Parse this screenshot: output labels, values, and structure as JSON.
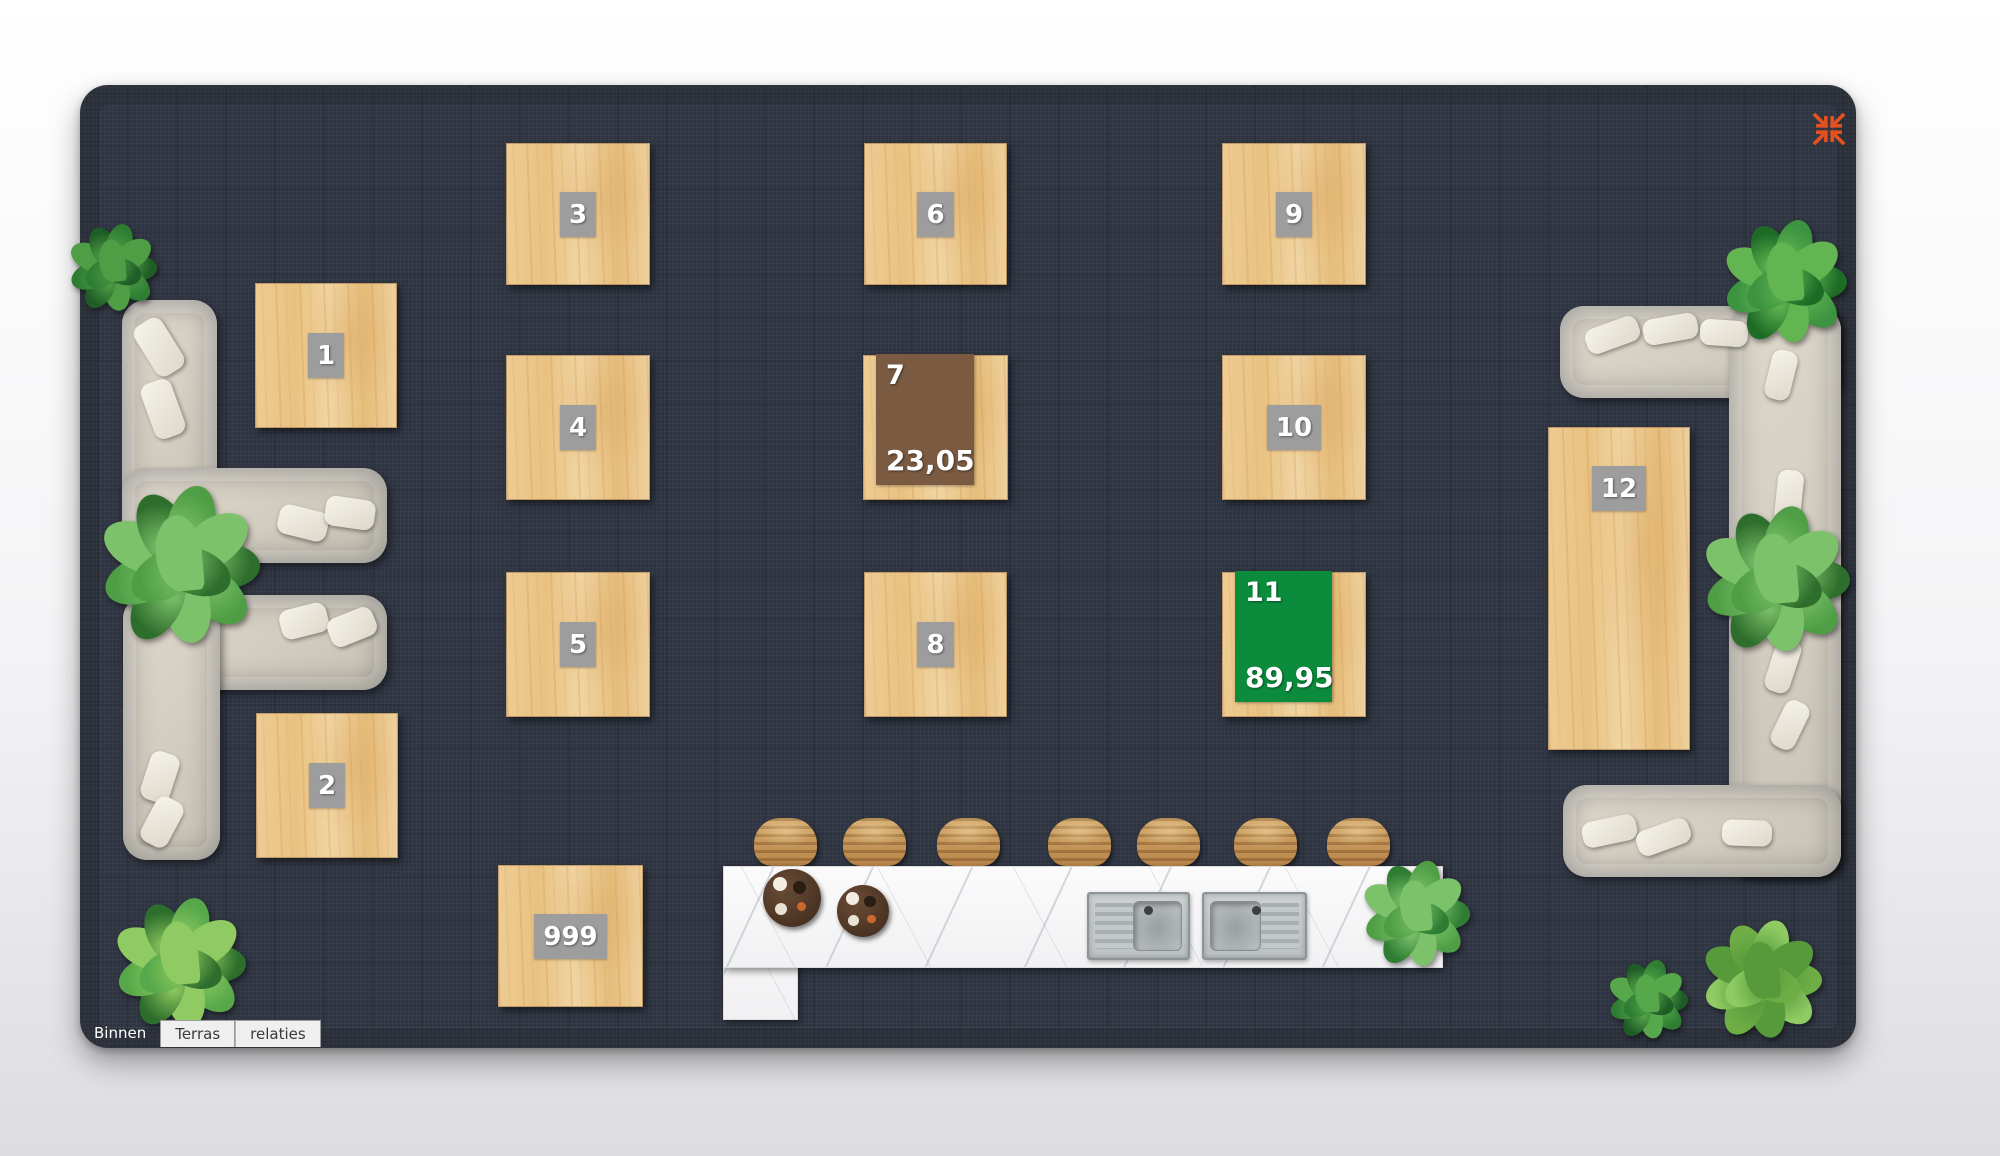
{
  "plan": {
    "x": 80,
    "y": 85,
    "w": 1776,
    "h": 963,
    "fabric_color": "#2f3542"
  },
  "tabs": [
    {
      "label": "Binnen",
      "active": true
    },
    {
      "label": "Terras",
      "active": false
    },
    {
      "label": "relaties",
      "active": false
    }
  ],
  "collapse_icon": {
    "x": 1812,
    "y": 112,
    "size": 34,
    "color": "#e4511e",
    "name": "collapse-icon"
  },
  "tables": [
    {
      "number": "1",
      "x": 255,
      "y": 283,
      "w": 142,
      "h": 145
    },
    {
      "number": "2",
      "x": 256,
      "y": 713,
      "w": 142,
      "h": 145
    },
    {
      "number": "3",
      "x": 506,
      "y": 143,
      "w": 144,
      "h": 142
    },
    {
      "number": "4",
      "x": 506,
      "y": 355,
      "w": 144,
      "h": 145
    },
    {
      "number": "5",
      "x": 506,
      "y": 572,
      "w": 144,
      "h": 145
    },
    {
      "number": "6",
      "x": 864,
      "y": 143,
      "w": 143,
      "h": 142
    },
    {
      "number": "7",
      "x": 863,
      "y": 355,
      "w": 145,
      "h": 145,
      "amount": "23,05",
      "overlay_color": "#7a5a41"
    },
    {
      "number": "8",
      "x": 864,
      "y": 572,
      "w": 143,
      "h": 145
    },
    {
      "number": "9",
      "x": 1222,
      "y": 143,
      "w": 144,
      "h": 142
    },
    {
      "number": "10",
      "x": 1222,
      "y": 355,
      "w": 144,
      "h": 145
    },
    {
      "number": "11",
      "x": 1222,
      "y": 572,
      "w": 144,
      "h": 145,
      "amount": "89,95",
      "overlay_color": "#0a8c3c"
    },
    {
      "number": "12",
      "x": 1548,
      "y": 427,
      "w": 142,
      "h": 323,
      "badge_pos": "top"
    },
    {
      "number": "999",
      "x": 498,
      "y": 865,
      "w": 145,
      "h": 142
    }
  ],
  "sofas": [
    {
      "name": "sofa-left-upper",
      "parts": [
        [
          122,
          300,
          95,
          263
        ],
        [
          122,
          468,
          265,
          95
        ]
      ],
      "pillows": [
        [
          143,
          318,
          32,
          58,
          -32
        ],
        [
          147,
          380,
          32,
          58,
          -20
        ],
        [
          278,
          508,
          50,
          30,
          14
        ],
        [
          325,
          498,
          50,
          30,
          8
        ]
      ]
    },
    {
      "name": "sofa-left-lower",
      "parts": [
        [
          123,
          595,
          264,
          95
        ],
        [
          123,
          595,
          97,
          265
        ]
      ],
      "pillows": [
        [
          280,
          606,
          48,
          30,
          -14
        ],
        [
          328,
          612,
          48,
          30,
          -22
        ],
        [
          145,
          752,
          30,
          50,
          18
        ],
        [
          147,
          797,
          30,
          50,
          28
        ]
      ]
    },
    {
      "name": "sofa-right",
      "parts": [
        [
          1560,
          306,
          281,
          92
        ],
        [
          1729,
          306,
          112,
          571
        ],
        [
          1563,
          785,
          278,
          92
        ]
      ],
      "pillows": [
        [
          1585,
          322,
          55,
          26,
          -20
        ],
        [
          1643,
          316,
          55,
          26,
          -10
        ],
        [
          1700,
          320,
          48,
          26,
          4
        ],
        [
          1768,
          350,
          26,
          50,
          14
        ],
        [
          1776,
          470,
          26,
          55,
          6
        ],
        [
          1770,
          638,
          26,
          55,
          18
        ],
        [
          1777,
          700,
          26,
          50,
          26
        ],
        [
          1582,
          818,
          55,
          26,
          -12
        ],
        [
          1636,
          824,
          55,
          26,
          -20
        ],
        [
          1722,
          820,
          50,
          26,
          2
        ]
      ]
    }
  ],
  "bar": {
    "counter": [
      723,
      866,
      720,
      102
    ],
    "column": [
      723,
      866,
      75,
      154
    ],
    "stool_y": 818,
    "stool_w": 63,
    "stool_h": 48,
    "stool_xs": [
      754,
      843,
      937,
      1048,
      1137,
      1234,
      1327
    ],
    "trays": [
      {
        "cx": 792,
        "cy": 898,
        "r": 29
      },
      {
        "cx": 863,
        "cy": 911,
        "r": 26
      }
    ],
    "sinks": [
      {
        "x": 1087,
        "y": 892,
        "w": 103,
        "h": 68,
        "flip": false
      },
      {
        "x": 1202,
        "y": 892,
        "w": 105,
        "h": 68,
        "flip": true
      }
    ]
  },
  "plants": [
    {
      "cx": 113,
      "cy": 268,
      "r": 44,
      "palette": [
        "#1e5d26",
        "#2f7d33",
        "#4f9e46"
      ]
    },
    {
      "cx": 180,
      "cy": 566,
      "r": 80,
      "palette": [
        "#2e6e2c",
        "#4f9e46",
        "#7cc26a"
      ]
    },
    {
      "cx": 180,
      "cy": 964,
      "r": 66,
      "palette": [
        "#2e6e2c",
        "#57a84a",
        "#8fcb62"
      ]
    },
    {
      "cx": 1785,
      "cy": 282,
      "r": 62,
      "palette": [
        "#1e6b26",
        "#3c9340",
        "#63b552"
      ]
    },
    {
      "cx": 1776,
      "cy": 580,
      "r": 74,
      "palette": [
        "#2e6e2c",
        "#4f9e46",
        "#7cc26a"
      ]
    },
    {
      "cx": 1648,
      "cy": 1000,
      "r": 40,
      "palette": [
        "#1d5c25",
        "#2f7d33",
        "#57a84a"
      ]
    },
    {
      "cx": 1762,
      "cy": 980,
      "r": 60,
      "palette": [
        "#6fae45",
        "#8fcb62",
        "#569a3c"
      ]
    },
    {
      "cx": 1416,
      "cy": 914,
      "r": 54,
      "palette": [
        "#2e7d33",
        "#4f9e46",
        "#7cc26a"
      ]
    }
  ]
}
